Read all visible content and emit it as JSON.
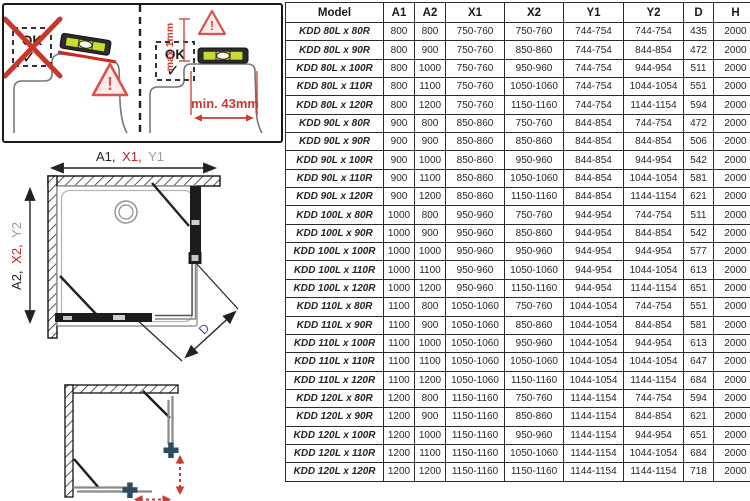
{
  "colors": {
    "accent_red": "#bf1f2a",
    "annotation_red": "#cc3b30",
    "dim_gray": "#9c9c9c",
    "d_purple": "#5145a0",
    "level_body": "#2d2d2d",
    "vial_green": "#c9da31",
    "cross_blue": "#2e4a63"
  },
  "icons": {
    "checkmark": "✓",
    "exclamation": "!"
  },
  "guide": {
    "wrong_ok_label": "OK",
    "right_ok_label": "OK",
    "max_gap_label": "max 1mm",
    "min_width_label": "min. 43mm"
  },
  "topview": {
    "horizontal_dim": {
      "a": "A1,",
      "x": "X1,",
      "y": "Y1"
    },
    "vertical_dim": {
      "a": "A2,",
      "x": "X2,",
      "y": "Y2"
    },
    "diagonal_label": "D"
  },
  "table": {
    "columns": [
      {
        "label": "Model",
        "class": "c-model"
      },
      {
        "label": "A1",
        "class": "c-black"
      },
      {
        "label": "A2",
        "class": "c-black"
      },
      {
        "label": "X1",
        "class": "c-red"
      },
      {
        "label": "X2",
        "class": "c-red"
      },
      {
        "label": "Y1",
        "class": "c-gray"
      },
      {
        "label": "Y2",
        "class": "c-gray"
      },
      {
        "label": "D",
        "class": "c-purple"
      },
      {
        "label": "H",
        "class": "c-black"
      }
    ],
    "rows": [
      [
        "KDD 80L x 80R",
        "800",
        "800",
        "750-760",
        "750-760",
        "744-754",
        "744-754",
        "435",
        "2000"
      ],
      [
        "KDD 80L x 90R",
        "800",
        "900",
        "750-760",
        "850-860",
        "744-754",
        "844-854",
        "472",
        "2000"
      ],
      [
        "KDD 80L x 100R",
        "800",
        "1000",
        "750-760",
        "950-960",
        "744-754",
        "944-954",
        "511",
        "2000"
      ],
      [
        "KDD 80L x 110R",
        "800",
        "1100",
        "750-760",
        "1050-1060",
        "744-754",
        "1044-1054",
        "551",
        "2000"
      ],
      [
        "KDD 80L x 120R",
        "800",
        "1200",
        "750-760",
        "1150-1160",
        "744-754",
        "1144-1154",
        "594",
        "2000"
      ],
      [
        "KDD 90L x 80R",
        "900",
        "800",
        "850-860",
        "750-760",
        "844-854",
        "744-754",
        "472",
        "2000"
      ],
      [
        "KDD 90L x 90R",
        "900",
        "900",
        "850-860",
        "850-860",
        "844-854",
        "844-854",
        "506",
        "2000"
      ],
      [
        "KDD 90L x 100R",
        "900",
        "1000",
        "850-860",
        "950-960",
        "844-854",
        "944-954",
        "542",
        "2000"
      ],
      [
        "KDD 90L x 110R",
        "900",
        "1100",
        "850-860",
        "1050-1060",
        "844-854",
        "1044-1054",
        "581",
        "2000"
      ],
      [
        "KDD 90L x 120R",
        "900",
        "1200",
        "850-860",
        "1150-1160",
        "844-854",
        "1144-1154",
        "621",
        "2000"
      ],
      [
        "KDD 100L x 80R",
        "1000",
        "800",
        "950-960",
        "750-760",
        "944-954",
        "744-754",
        "511",
        "2000"
      ],
      [
        "KDD 100L x 90R",
        "1000",
        "900",
        "950-960",
        "850-860",
        "944-954",
        "844-854",
        "542",
        "2000"
      ],
      [
        "KDD 100L x 100R",
        "1000",
        "1000",
        "950-960",
        "950-960",
        "944-954",
        "944-954",
        "577",
        "2000"
      ],
      [
        "KDD 100L x 110R",
        "1000",
        "1100",
        "950-960",
        "1050-1060",
        "944-954",
        "1044-1054",
        "613",
        "2000"
      ],
      [
        "KDD 100L x 120R",
        "1000",
        "1200",
        "950-960",
        "1150-1160",
        "944-954",
        "1144-1154",
        "651",
        "2000"
      ],
      [
        "KDD 110L x 80R",
        "1100",
        "800",
        "1050-1060",
        "750-760",
        "1044-1054",
        "744-754",
        "551",
        "2000"
      ],
      [
        "KDD 110L x 90R",
        "1100",
        "900",
        "1050-1060",
        "850-860",
        "1044-1054",
        "844-854",
        "581",
        "2000"
      ],
      [
        "KDD 110L x 100R",
        "1100",
        "1000",
        "1050-1060",
        "950-960",
        "1044-1054",
        "944-954",
        "613",
        "2000"
      ],
      [
        "KDD 110L x 110R",
        "1100",
        "1100",
        "1050-1060",
        "1050-1060",
        "1044-1054",
        "1044-1054",
        "647",
        "2000"
      ],
      [
        "KDD 110L x 120R",
        "1100",
        "1200",
        "1050-1060",
        "1150-1160",
        "1044-1054",
        "1144-1154",
        "684",
        "2000"
      ],
      [
        "KDD 120L x 80R",
        "1200",
        "800",
        "1150-1160",
        "750-760",
        "1144-1154",
        "744-754",
        "594",
        "2000"
      ],
      [
        "KDD 120L x 90R",
        "1200",
        "900",
        "1150-1160",
        "850-860",
        "1144-1154",
        "844-854",
        "621",
        "2000"
      ],
      [
        "KDD 120L x 100R",
        "1200",
        "1000",
        "1150-1160",
        "950-960",
        "1144-1154",
        "944-954",
        "651",
        "2000"
      ],
      [
        "KDD 120L x 110R",
        "1200",
        "1100",
        "1150-1160",
        "1050-1060",
        "1144-1154",
        "1044-1054",
        "684",
        "2000"
      ],
      [
        "KDD 120L x 120R",
        "1200",
        "1200",
        "1150-1160",
        "1150-1160",
        "1144-1154",
        "1144-1154",
        "718",
        "2000"
      ]
    ]
  }
}
